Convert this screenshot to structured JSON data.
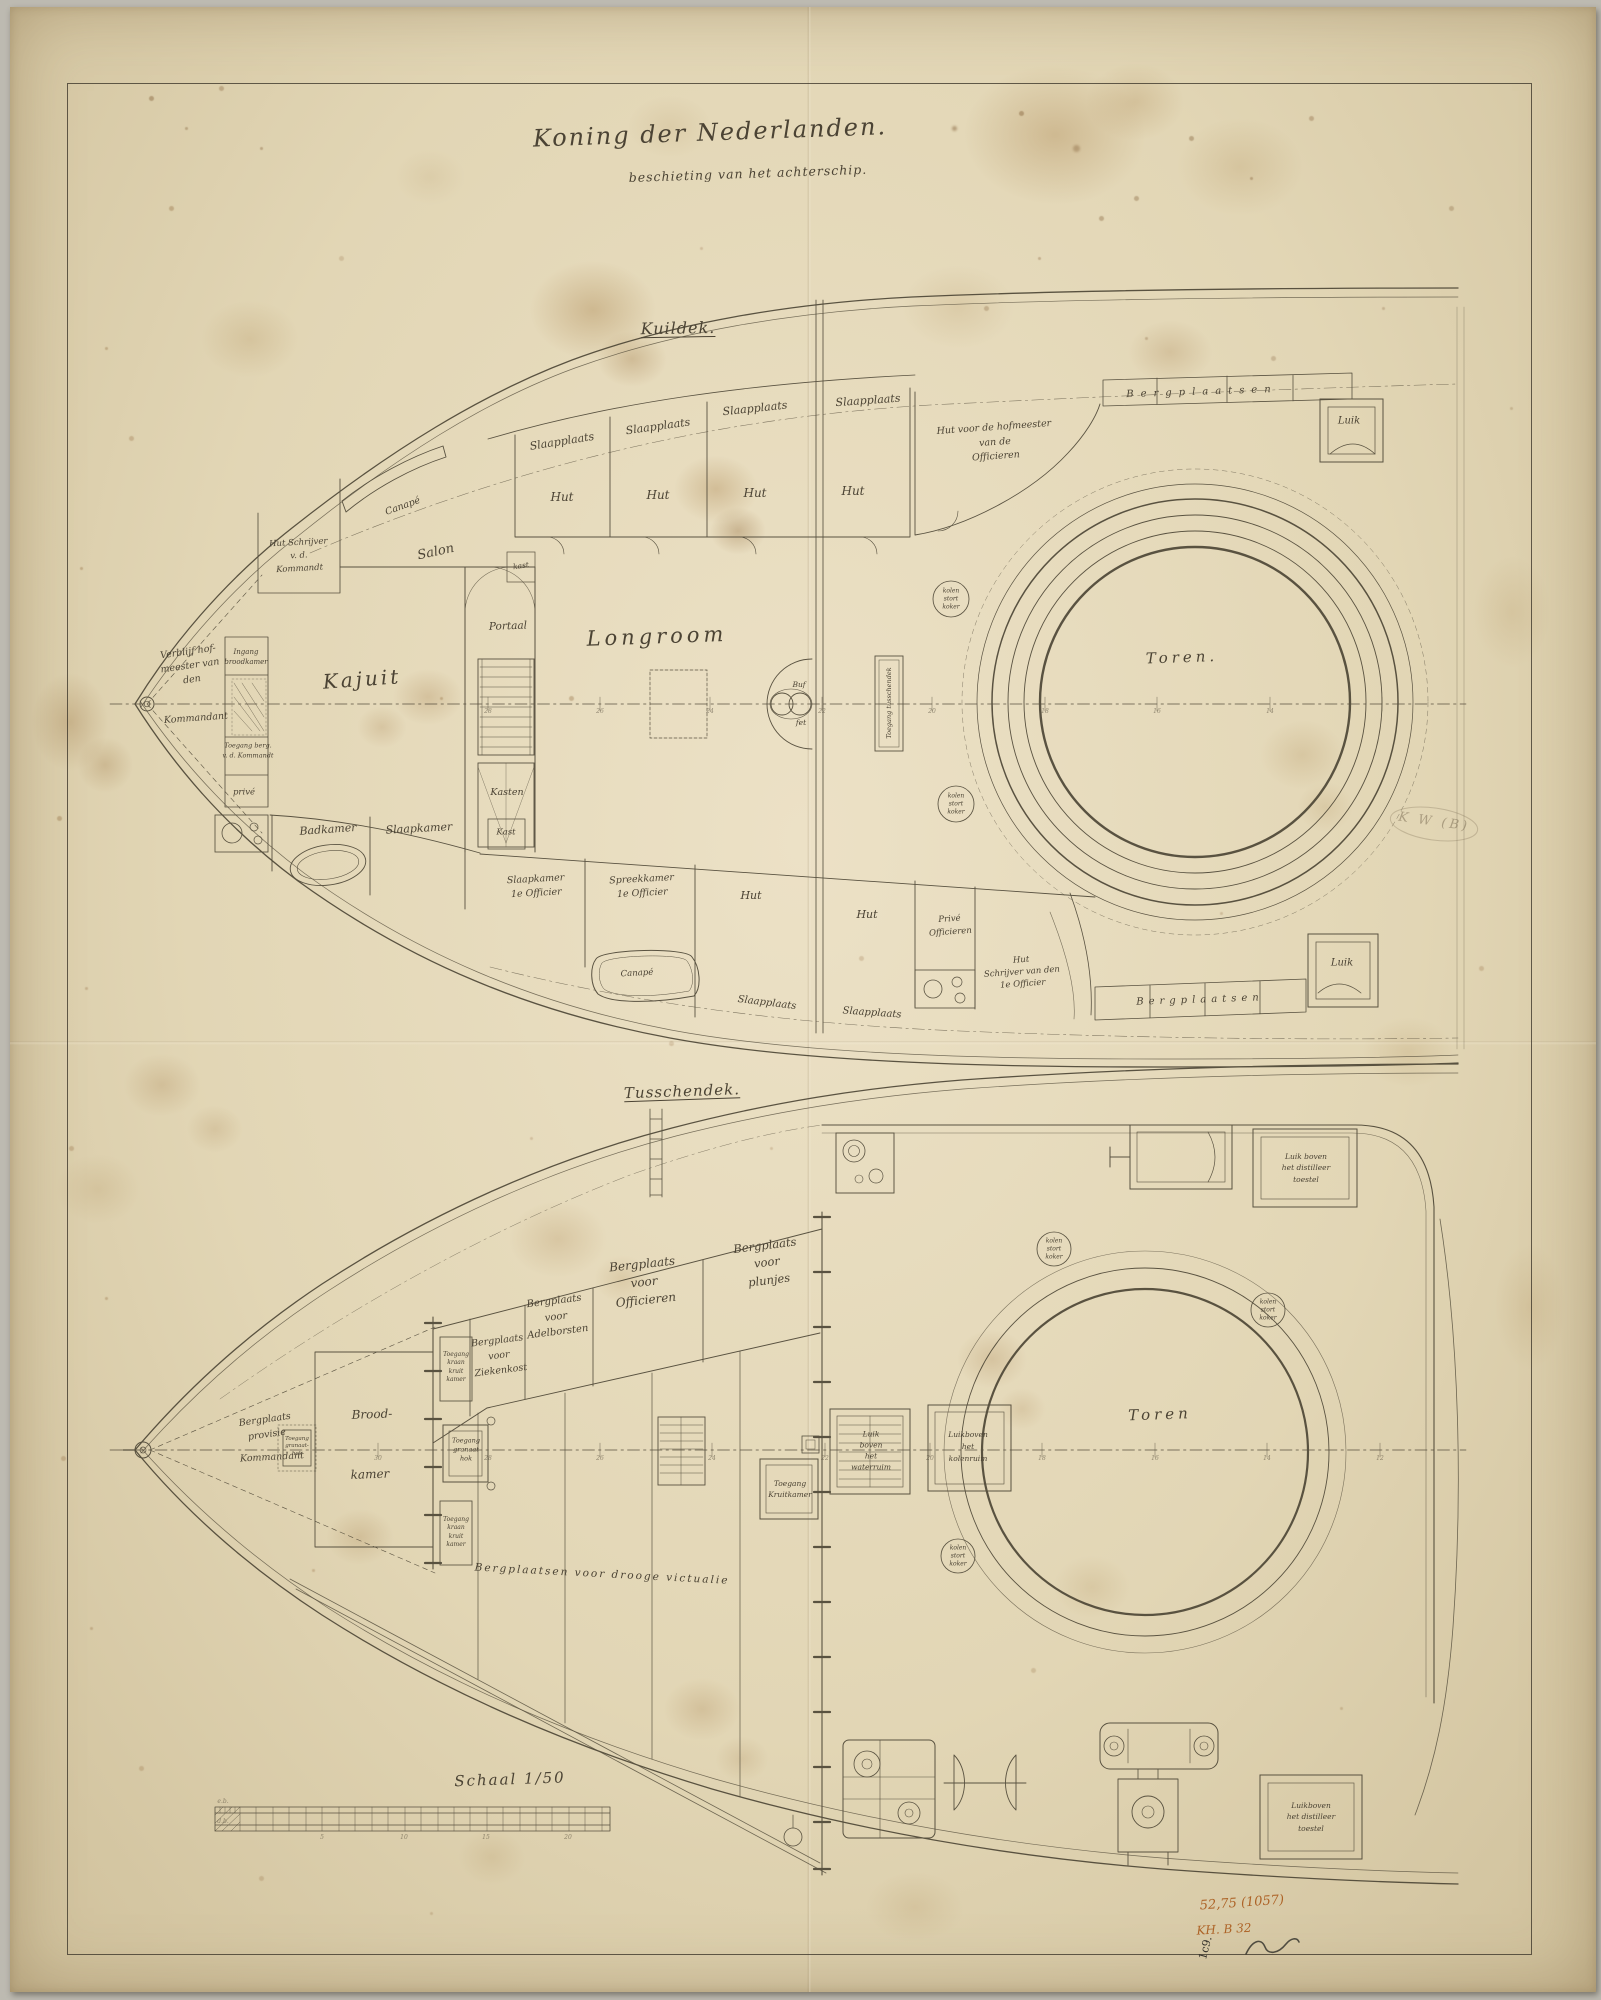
{
  "document": {
    "title": "Koning der Nederlanden.",
    "subtitle": "beschieting van het achterschip."
  },
  "decks": [
    {
      "id": "kuildek",
      "title": "Kuildek."
    },
    {
      "id": "tusschendek",
      "title": "Tusschendek."
    }
  ],
  "scale": {
    "label": "Schaal 1/50"
  },
  "marks": {
    "inventory": "52,75 (1057)",
    "catalog": "KH. B 32",
    "corner": "1c9.",
    "pencil": "K W (B)"
  },
  "palette": {
    "paper": "#e4dabc",
    "ink": "#4d4636",
    "accent": "#ad6327"
  },
  "labels": [
    {
      "n": "label-slaapplaats-1",
      "t": "Slaapplaats",
      "x": 552,
      "y": 435,
      "s": 11,
      "r": -9
    },
    {
      "n": "label-slaapplaats-2",
      "t": "Slaapplaats",
      "x": 648,
      "y": 420,
      "s": 11,
      "r": -8
    },
    {
      "n": "label-slaapplaats-3",
      "t": "Slaapplaats",
      "x": 745,
      "y": 402,
      "s": 11,
      "r": -6
    },
    {
      "n": "label-slaapplaats-4",
      "t": "Slaapplaats",
      "x": 858,
      "y": 394,
      "s": 11,
      "r": -4
    },
    {
      "n": "label-hut-1",
      "t": "Hut",
      "x": 552,
      "y": 491,
      "s": 12
    },
    {
      "n": "label-hut-2",
      "t": "Hut",
      "x": 648,
      "y": 489,
      "s": 12
    },
    {
      "n": "label-hut-3",
      "t": "Hut",
      "x": 745,
      "y": 487,
      "s": 12
    },
    {
      "n": "label-hut-4",
      "t": "Hut",
      "x": 843,
      "y": 485,
      "s": 12
    },
    {
      "n": "label-hut-hofmeester",
      "t": "Hut voor de hofmeester\nvan de\nOfficieren",
      "x": 985,
      "y": 436,
      "s": 9.5,
      "r": -4,
      "lh": 1.55
    },
    {
      "n": "label-bergplaatsen-top",
      "t": "Bergplaatsen",
      "x": 1192,
      "y": 385,
      "s": 10,
      "r": -2,
      "ls": 7
    },
    {
      "n": "label-luik-top",
      "t": "Luik",
      "x": 1339,
      "y": 414,
      "s": 10
    },
    {
      "n": "label-canape-top",
      "t": "Canapé",
      "x": 393,
      "y": 500,
      "s": 9.5,
      "r": -20
    },
    {
      "n": "label-salon",
      "t": "Salon",
      "x": 426,
      "y": 546,
      "s": 13,
      "r": -12
    },
    {
      "n": "label-hut-schrijver-kommandant",
      "t": "Hut Schrijver\nv. d.\nKommandt",
      "x": 289,
      "y": 549,
      "s": 8.5,
      "r": -3,
      "lh": 1.5
    },
    {
      "n": "label-verblijf-hofmeester",
      "t": "Verblijf hof-\nmeester van\nden",
      "x": 180,
      "y": 659,
      "s": 9.5,
      "r": -8,
      "lh": 1.45
    },
    {
      "n": "label-kommandant",
      "t": "Kommandant",
      "x": 186,
      "y": 712,
      "s": 9.5,
      "r": -4
    },
    {
      "n": "label-ingang-broodkamer",
      "t": "Ingang\nbroodkamer",
      "x": 236,
      "y": 651,
      "s": 7,
      "lh": 1.4
    },
    {
      "n": "label-toegang-berg",
      "t": "Toegang berg.\nv. d. Kommandt",
      "x": 238,
      "y": 744,
      "s": 6.5,
      "lh": 1.5
    },
    {
      "n": "label-prive-bow",
      "t": "privé",
      "x": 234,
      "y": 786,
      "s": 8.5
    },
    {
      "n": "label-kajuit",
      "t": "Kajuit",
      "x": 352,
      "y": 672,
      "s": 20,
      "r": -4,
      "ls": 3
    },
    {
      "n": "label-kast-small",
      "t": "kast",
      "x": 511,
      "y": 559,
      "s": 7.5,
      "r": -8
    },
    {
      "n": "label-portaal",
      "t": "Portaal",
      "x": 498,
      "y": 620,
      "s": 10.5,
      "r": -2
    },
    {
      "n": "label-kasten",
      "t": "Kasten",
      "x": 497,
      "y": 786,
      "s": 9.5
    },
    {
      "n": "label-longroom",
      "t": "Longroom",
      "x": 647,
      "y": 630,
      "s": 21,
      "r": -2,
      "ls": 4
    },
    {
      "n": "label-buffet-top",
      "t": "Buf",
      "x": 789,
      "y": 678,
      "s": 7.5
    },
    {
      "n": "label-buffet-bottom",
      "t": "fet",
      "x": 791,
      "y": 716,
      "s": 7.5
    },
    {
      "n": "label-toegang-tusschendek",
      "t": "Toegang tusschendek",
      "x": 879,
      "y": 696,
      "s": 6.5,
      "r": -90
    },
    {
      "n": "label-kolenkoker-1",
      "t": "kolen\nstort\nkoker",
      "x": 941,
      "y": 592,
      "s": 6,
      "lh": 1.3
    },
    {
      "n": "label-kolenkoker-2",
      "t": "kolen\nstort\nkoker",
      "x": 946,
      "y": 797,
      "s": 6,
      "lh": 1.3
    },
    {
      "n": "label-toren-kuildek",
      "t": "Toren.",
      "x": 1172,
      "y": 651,
      "s": 15,
      "r": -2,
      "ls": 4
    },
    {
      "n": "label-badkamer",
      "t": "Badkamer",
      "x": 318,
      "y": 823,
      "s": 11,
      "r": -4
    },
    {
      "n": "label-slaapkamer",
      "t": "Slaapkamer",
      "x": 409,
      "y": 822,
      "s": 11,
      "r": -3
    },
    {
      "n": "label-kast",
      "t": "Kast",
      "x": 496,
      "y": 826,
      "s": 8.5
    },
    {
      "n": "label-slaapkamer-1e-officier",
      "t": "Slaapkamer\n1e Officier",
      "x": 526,
      "y": 880,
      "s": 9.5,
      "r": -3,
      "lh": 1.5
    },
    {
      "n": "label-spreekkamer-1e-officier",
      "t": "Spreekkamer\n1e Officier",
      "x": 632,
      "y": 880,
      "s": 9.5,
      "r": -3,
      "lh": 1.5
    },
    {
      "n": "label-hut-5",
      "t": "Hut",
      "x": 741,
      "y": 889,
      "s": 11
    },
    {
      "n": "label-hut-6",
      "t": "Hut",
      "x": 857,
      "y": 908,
      "s": 11
    },
    {
      "n": "label-prive-officieren",
      "t": "Privé\nOfficieren",
      "x": 940,
      "y": 919,
      "s": 8.5,
      "r": -4,
      "lh": 1.5
    },
    {
      "n": "label-hut-schrijver-1e-officier",
      "t": "Hut\nSchrijver van den\n1e Officier",
      "x": 1012,
      "y": 966,
      "s": 8.5,
      "r": -4,
      "lh": 1.4
    },
    {
      "n": "label-canape-bottom",
      "t": "Canapé",
      "x": 627,
      "y": 967,
      "s": 8.5,
      "r": -3
    },
    {
      "n": "label-slaapplaats-5",
      "t": "Slaapplaats",
      "x": 757,
      "y": 996,
      "s": 10,
      "r": 7
    },
    {
      "n": "label-slaapplaats-6",
      "t": "Slaapplaats",
      "x": 862,
      "y": 1006,
      "s": 10,
      "r": 4
    },
    {
      "n": "label-bergplaatsen-bottom",
      "t": "Bergplaatsen",
      "x": 1190,
      "y": 993,
      "s": 10,
      "r": -2,
      "ls": 5
    },
    {
      "n": "label-luik-bottom",
      "t": "Luik",
      "x": 1332,
      "y": 956,
      "s": 10
    },
    {
      "n": "station-number",
      "t": "28",
      "x": 478,
      "y": 705,
      "s": 6,
      "cls": "faint"
    },
    {
      "n": "station-number",
      "t": "26",
      "x": 590,
      "y": 705,
      "s": 6,
      "cls": "faint"
    },
    {
      "n": "station-number",
      "t": "24",
      "x": 700,
      "y": 705,
      "s": 6,
      "cls": "faint"
    },
    {
      "n": "station-number",
      "t": "22",
      "x": 812,
      "y": 705,
      "s": 6,
      "cls": "faint"
    },
    {
      "n": "station-number",
      "t": "20",
      "x": 922,
      "y": 705,
      "s": 6,
      "cls": "faint"
    },
    {
      "n": "station-number",
      "t": "18",
      "x": 1035,
      "y": 705,
      "s": 6,
      "cls": "faint"
    },
    {
      "n": "station-number",
      "t": "16",
      "x": 1147,
      "y": 705,
      "s": 6,
      "cls": "faint"
    },
    {
      "n": "station-number",
      "t": "14",
      "x": 1260,
      "y": 705,
      "s": 6,
      "cls": "faint"
    },
    {
      "n": "label-bergplaats-provisie",
      "t": "Bergplaats\nprovisie",
      "x": 256,
      "y": 1421,
      "s": 9.5,
      "r": -8,
      "lh": 1.55
    },
    {
      "n": "label-kommandant-2",
      "t": "Kommandant",
      "x": 262,
      "y": 1451,
      "s": 9.5,
      "r": -3
    },
    {
      "n": "label-toegang-granaathok-left",
      "t": "Toegang\ngranaat-\nhok",
      "x": 287,
      "y": 1440,
      "s": 5.5,
      "lh": 1.35
    },
    {
      "n": "label-broodkamer-1",
      "t": "Brood-",
      "x": 362,
      "y": 1408,
      "s": 12,
      "r": -2
    },
    {
      "n": "label-broodkamer-2",
      "t": "kamer",
      "x": 360,
      "y": 1468,
      "s": 12,
      "r": -2
    },
    {
      "n": "label-toegang-granaathok",
      "t": "Toegang\ngranaat\nhok",
      "x": 456,
      "y": 1443,
      "s": 6.5,
      "lh": 1.4
    },
    {
      "n": "label-toegang-kraan-kruitkamer-1",
      "t": "Toegang\nkraan\nkruit\nkamer",
      "x": 446,
      "y": 1361,
      "s": 6,
      "lh": 1.4
    },
    {
      "n": "label-toegang-kraan-kruitkamer-2",
      "t": "Toegang\nkraan\nkruit\nkamer",
      "x": 446,
      "y": 1526,
      "s": 6,
      "lh": 1.4
    },
    {
      "n": "label-bergplaats-ziekenkost",
      "t": "Bergplaats\nvoor\nZiekenkost",
      "x": 489,
      "y": 1349,
      "s": 9.5,
      "r": -7,
      "lh": 1.6
    },
    {
      "n": "label-bergplaats-adelborsten",
      "t": "Bergplaats\nvoor\nAdelborsten",
      "x": 546,
      "y": 1310,
      "s": 10,
      "r": -7,
      "lh": 1.55
    },
    {
      "n": "label-bergplaats-officieren",
      "t": "Bergplaats\nvoor\nOfficieren",
      "x": 634,
      "y": 1275,
      "s": 12,
      "r": -6,
      "lh": 1.5
    },
    {
      "n": "label-bergplaats-plunjes",
      "t": "Bergplaats\nvoor\nplunjes",
      "x": 757,
      "y": 1256,
      "s": 11.5,
      "r": -7,
      "lh": 1.5
    },
    {
      "n": "label-bergplaatsen-victualie",
      "t": "Bergplaatsen voor drooge victualie",
      "x": 592,
      "y": 1568,
      "s": 10.5,
      "r": 3,
      "ls": 2
    },
    {
      "n": "label-toegang-kruitkamer",
      "t": "Toegang\nKruitkamer",
      "x": 780,
      "y": 1482,
      "s": 7.5,
      "lh": 1.5
    },
    {
      "n": "label-luik-waterruim",
      "t": "Luik\nboven\nhet\nwaterruim",
      "x": 861,
      "y": 1444,
      "s": 7.5,
      "lh": 1.45
    },
    {
      "n": "label-luik-kolenruim",
      "t": "Luikboven\nhet\nkolenruim",
      "x": 958,
      "y": 1440,
      "s": 7.5,
      "lh": 1.6
    },
    {
      "n": "label-kolenkoker-3",
      "t": "kolen\nstort\nkoker",
      "x": 948,
      "y": 1549,
      "s": 6,
      "lh": 1.3
    },
    {
      "n": "label-kolenkoker-4",
      "t": "kolen\nstort\nkoker",
      "x": 1044,
      "y": 1242,
      "s": 6,
      "lh": 1.3
    },
    {
      "n": "label-kolenkoker-5",
      "t": "kolen\nstort\nkoker",
      "x": 1258,
      "y": 1303,
      "s": 6,
      "lh": 1.3
    },
    {
      "n": "label-toren-tusschendek",
      "t": "Toren",
      "x": 1150,
      "y": 1408,
      "s": 15,
      "r": -2,
      "ls": 4
    },
    {
      "n": "label-luik-distilleer-top",
      "t": "Luik boven\nhet distilleer\ntoestel",
      "x": 1296,
      "y": 1161,
      "s": 7.5,
      "lh": 1.5
    },
    {
      "n": "label-luik-distilleer-bottom",
      "t": "Luikboven\nhet distilleer\ntoestel",
      "x": 1301,
      "y": 1810,
      "s": 7.5,
      "lh": 1.5
    },
    {
      "n": "station-number",
      "t": "30",
      "x": 368,
      "y": 1452,
      "s": 6,
      "cls": "faint"
    },
    {
      "n": "station-number",
      "t": "28",
      "x": 478,
      "y": 1452,
      "s": 6,
      "cls": "faint"
    },
    {
      "n": "station-number",
      "t": "26",
      "x": 590,
      "y": 1452,
      "s": 6,
      "cls": "faint"
    },
    {
      "n": "station-number",
      "t": "24",
      "x": 702,
      "y": 1452,
      "s": 6,
      "cls": "faint"
    },
    {
      "n": "station-number",
      "t": "22",
      "x": 815,
      "y": 1452,
      "s": 6,
      "cls": "faint"
    },
    {
      "n": "station-number",
      "t": "20",
      "x": 920,
      "y": 1452,
      "s": 6,
      "cls": "faint"
    },
    {
      "n": "station-number",
      "t": "18",
      "x": 1032,
      "y": 1452,
      "s": 6,
      "cls": "faint"
    },
    {
      "n": "station-number",
      "t": "16",
      "x": 1145,
      "y": 1452,
      "s": 6,
      "cls": "faint"
    },
    {
      "n": "station-number",
      "t": "14",
      "x": 1257,
      "y": 1452,
      "s": 6,
      "cls": "faint"
    },
    {
      "n": "station-number",
      "t": "12",
      "x": 1370,
      "y": 1452,
      "s": 6,
      "cls": "faint"
    },
    {
      "n": "label-scale-eb",
      "t": "e.b.",
      "x": 213,
      "y": 1795,
      "s": 6,
      "cls": "faint"
    },
    {
      "n": "label-scale-db",
      "t": "d.b.",
      "x": 213,
      "y": 1815,
      "s": 6,
      "cls": "faint"
    },
    {
      "n": "scale-number",
      "t": "5",
      "x": 312,
      "y": 1831,
      "s": 6,
      "cls": "faint"
    },
    {
      "n": "scale-number",
      "t": "10",
      "x": 394,
      "y": 1831,
      "s": 6,
      "cls": "faint"
    },
    {
      "n": "scale-number",
      "t": "15",
      "x": 476,
      "y": 1831,
      "s": 6,
      "cls": "faint"
    },
    {
      "n": "scale-number",
      "t": "20",
      "x": 558,
      "y": 1831,
      "s": 6,
      "cls": "faint"
    }
  ]
}
